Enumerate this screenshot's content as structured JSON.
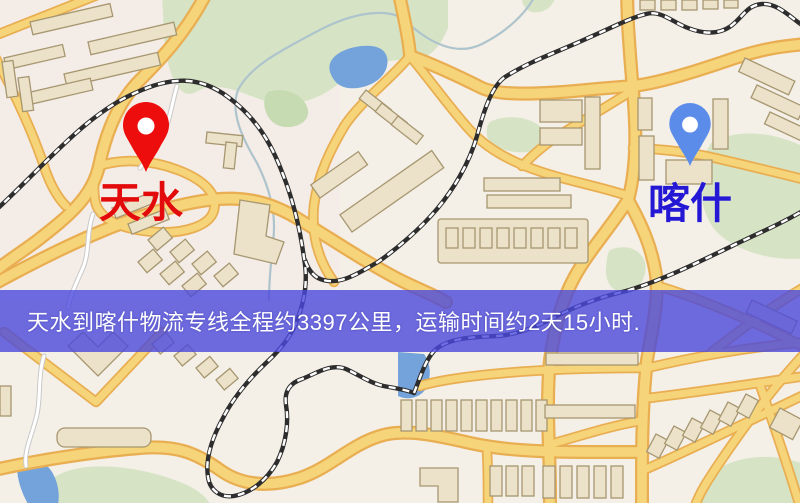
{
  "banner": {
    "text": "天水到喀什物流专线全程约3397公里，运输时间约2天15小时.",
    "background": "#4b48dc",
    "text_color": "#ffffff"
  },
  "markers": {
    "origin": {
      "label": "天水",
      "label_color": "#e20a0a",
      "pin_color": "#ee0d0d"
    },
    "destination": {
      "label": "喀什",
      "label_color": "#2518d4",
      "pin_color": "#5b8cea"
    }
  },
  "map_colors": {
    "background": "#f4efe7",
    "road_fill": "#f6d57a",
    "road_casing": "#e9ae52",
    "building_fill": "#ebe2c9",
    "building_stroke": "#a79771",
    "park": "#d6e4c5",
    "park_dark": "#c6dbb1",
    "water": "#73a3da",
    "railway": "#2d2d2d",
    "stream": "#aec4cc",
    "white_road": "#ffffff",
    "white_road_casing": "#c9c9c9"
  }
}
